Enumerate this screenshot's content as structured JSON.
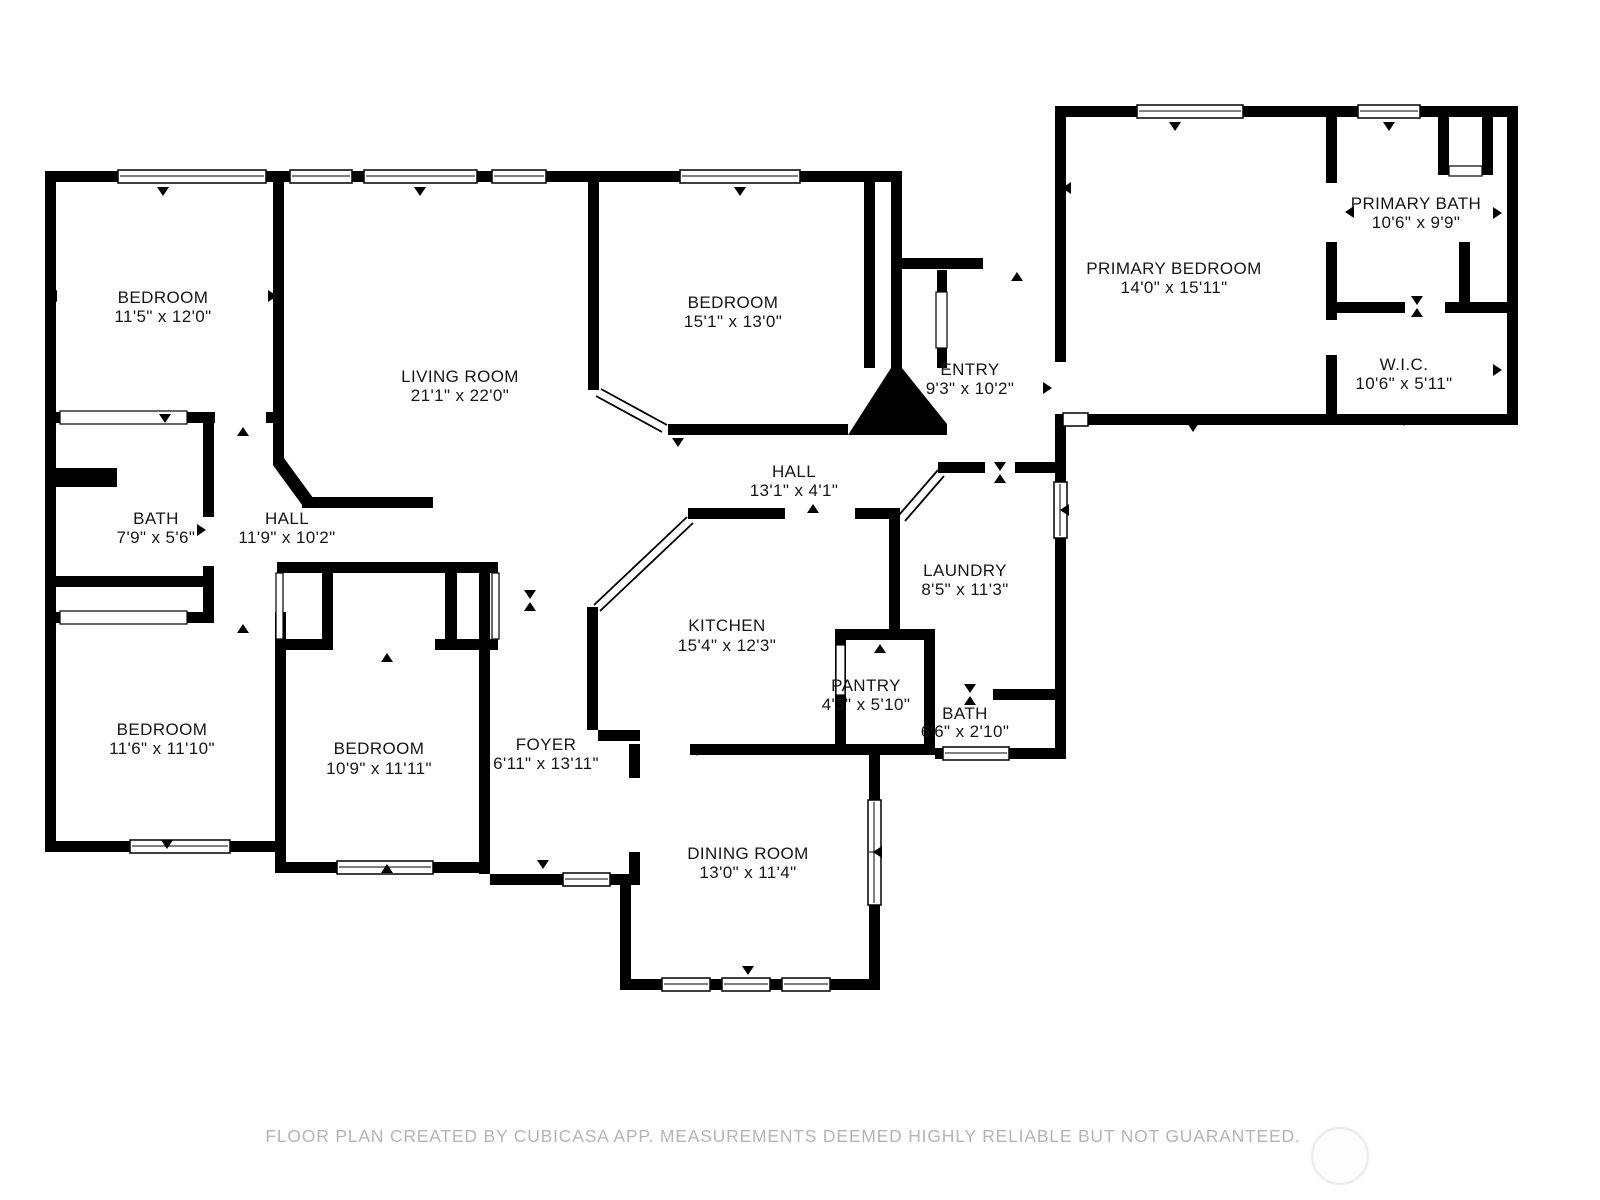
{
  "rooms": [
    {
      "name": "BEDROOM",
      "dims": "11'5\" x 12'0\""
    },
    {
      "name": "LIVING ROOM",
      "dims": "21'1\" x 22'0\""
    },
    {
      "name": "BEDROOM",
      "dims": "15'1\" x 13'0\""
    },
    {
      "name": "ENTRY",
      "dims": "9'3\" x 10'2\""
    },
    {
      "name": "PRIMARY BEDROOM",
      "dims": "14'0\" x 15'11\""
    },
    {
      "name": "PRIMARY BATH",
      "dims": "10'6\" x 9'9\""
    },
    {
      "name": "W.I.C.",
      "dims": "10'6\" x 5'11\""
    },
    {
      "name": "HALL",
      "dims": "13'1\" x 4'1\""
    },
    {
      "name": "BATH",
      "dims": "7'9\" x 5'6\""
    },
    {
      "name": "HALL",
      "dims": "11'9\" x 10'2\""
    },
    {
      "name": "LAUNDRY",
      "dims": "8'5\" x 11'3\""
    },
    {
      "name": "KITCHEN",
      "dims": "15'4\" x 12'3\""
    },
    {
      "name": "PANTRY",
      "dims": "4'3\" x 5'10\""
    },
    {
      "name": "BATH",
      "dims": "6'6\" x 2'10\""
    },
    {
      "name": "BEDROOM",
      "dims": "11'6\" x 11'10\""
    },
    {
      "name": "BEDROOM",
      "dims": "10'9\" x 11'11\""
    },
    {
      "name": "FOYER",
      "dims": "6'11\" x 13'11\""
    },
    {
      "name": "DINING ROOM",
      "dims": "13'0\" x 11'4\""
    }
  ],
  "footer": {
    "disclaimer": "FLOOR PLAN CREATED BY CUBICASA APP. MEASUREMENTS DEEMED HIGHLY RELIABLE BUT NOT GUARANTEED."
  },
  "colors": {
    "wall": "#000000",
    "background": "#ffffff",
    "footer_text": "#b5b5b5",
    "watermark_ring": "#ececec"
  }
}
